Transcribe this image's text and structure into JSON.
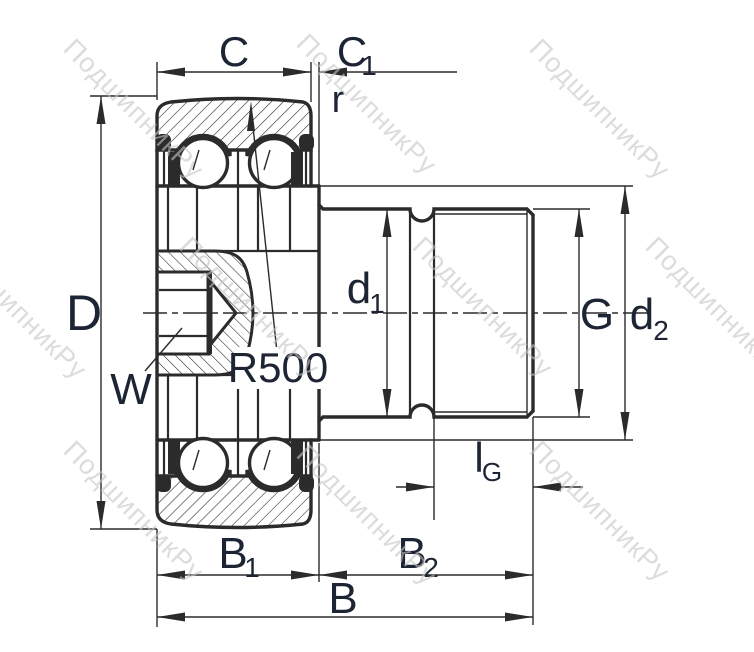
{
  "title": "Stud-type track roller bearing cross-section drawing",
  "watermark": {
    "text": "ПодшипникРу",
    "color": "#c5c5c5"
  },
  "colors": {
    "background": "#ffffff",
    "line": "#2b2b2b",
    "text": "#1d2433"
  },
  "dimensions": {
    "C": {
      "label": "C"
    },
    "C1": {
      "base": "C",
      "sub": "1"
    },
    "r": {
      "label": "r"
    },
    "D": {
      "label": "D"
    },
    "W": {
      "label": "W"
    },
    "R500": {
      "label": "R500"
    },
    "d1": {
      "base": "d",
      "sub": "1"
    },
    "G": {
      "label": "G"
    },
    "d2": {
      "base": "d",
      "sub": "2"
    },
    "lG": {
      "base": "l",
      "sub": "G"
    },
    "B1": {
      "base": "B",
      "sub": "1"
    },
    "B2": {
      "base": "B",
      "sub": "2"
    },
    "B": {
      "label": "B"
    }
  }
}
